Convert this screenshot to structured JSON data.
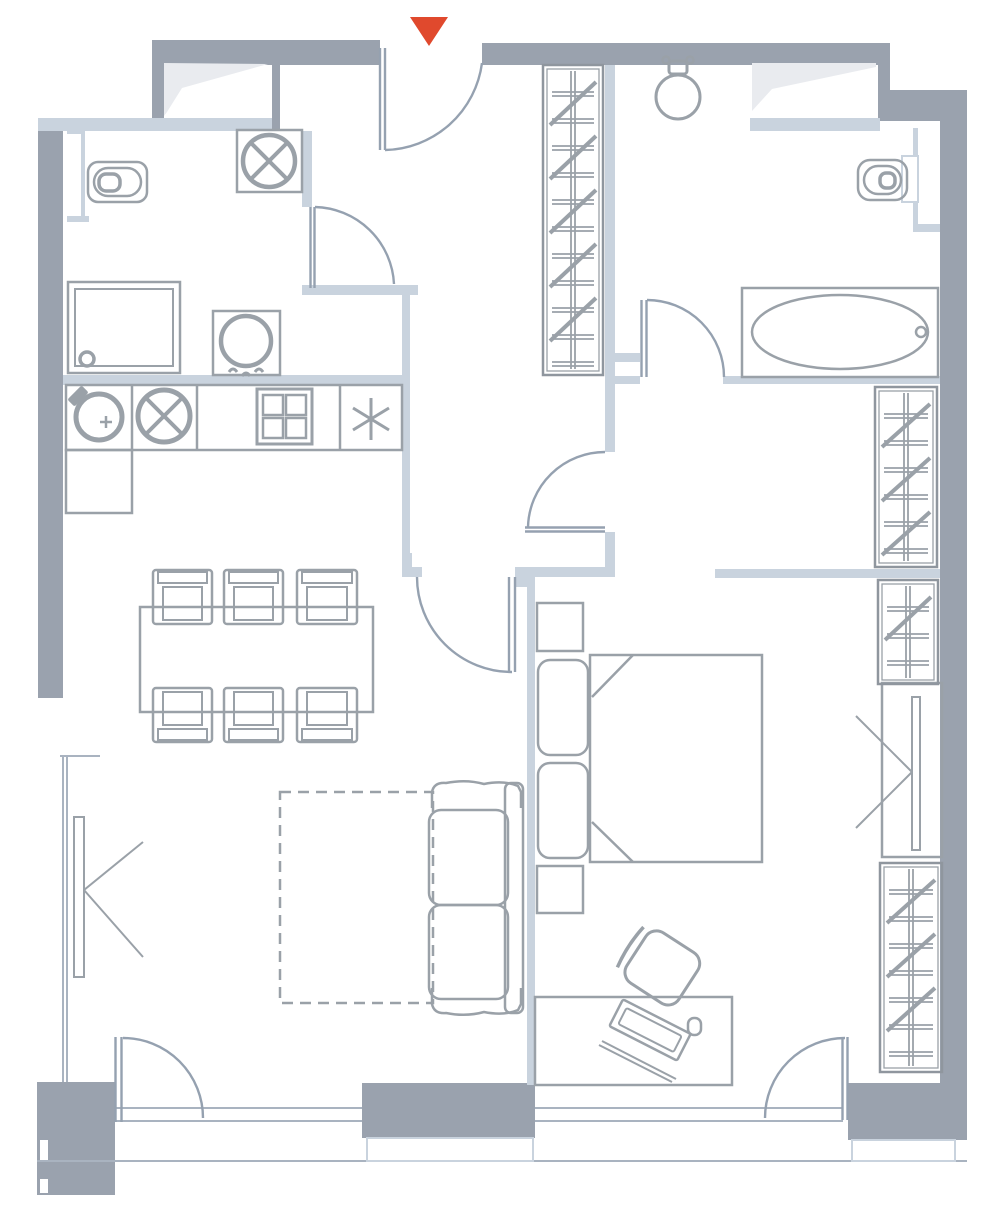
{
  "plan": {
    "canvas": {
      "width": 1000,
      "height": 1231
    },
    "colors": {
      "wall": "#9aa2ae",
      "wall_light": "#c9d3de",
      "line": "#9aa1a8",
      "line_strong": "#8f969e",
      "door": "#95a1b0",
      "glass": "#a9b3c0",
      "accent": "#e0492d",
      "window_panel": "#e9ebef",
      "background": "#ffffff"
    },
    "entrance_marker": {
      "points": "410,17 448,17 429,46",
      "color": "#e0492d"
    },
    "closets": [
      {
        "id": "wardrobe-hall",
        "x": 543,
        "y": 65,
        "w": 60,
        "h": 310
      },
      {
        "id": "closet-upper-right",
        "x": 875,
        "y": 387,
        "w": 62,
        "h": 180
      },
      {
        "id": "closet-mid-right",
        "x": 878,
        "y": 580,
        "w": 60,
        "h": 104
      },
      {
        "id": "closet-lower-right",
        "x": 880,
        "y": 863,
        "w": 62,
        "h": 209
      }
    ],
    "closet_style": {
      "rung_spacing": 27,
      "rung_gap": 4,
      "inset": 4
    },
    "rug": {
      "dash": "11 7"
    },
    "fixture_icons": [
      "toilet-icon",
      "washbasin-icon",
      "shower-icon",
      "washing-machine-icon",
      "kettle-icon",
      "sink-icon",
      "stove-icon",
      "snowflake-icon",
      "bathtub-icon",
      "bed-icon",
      "sofa-icon",
      "tv-icon",
      "desk-chair-icon",
      "laptop-icon",
      "mouse-icon",
      "entrance-arrow-icon"
    ]
  }
}
